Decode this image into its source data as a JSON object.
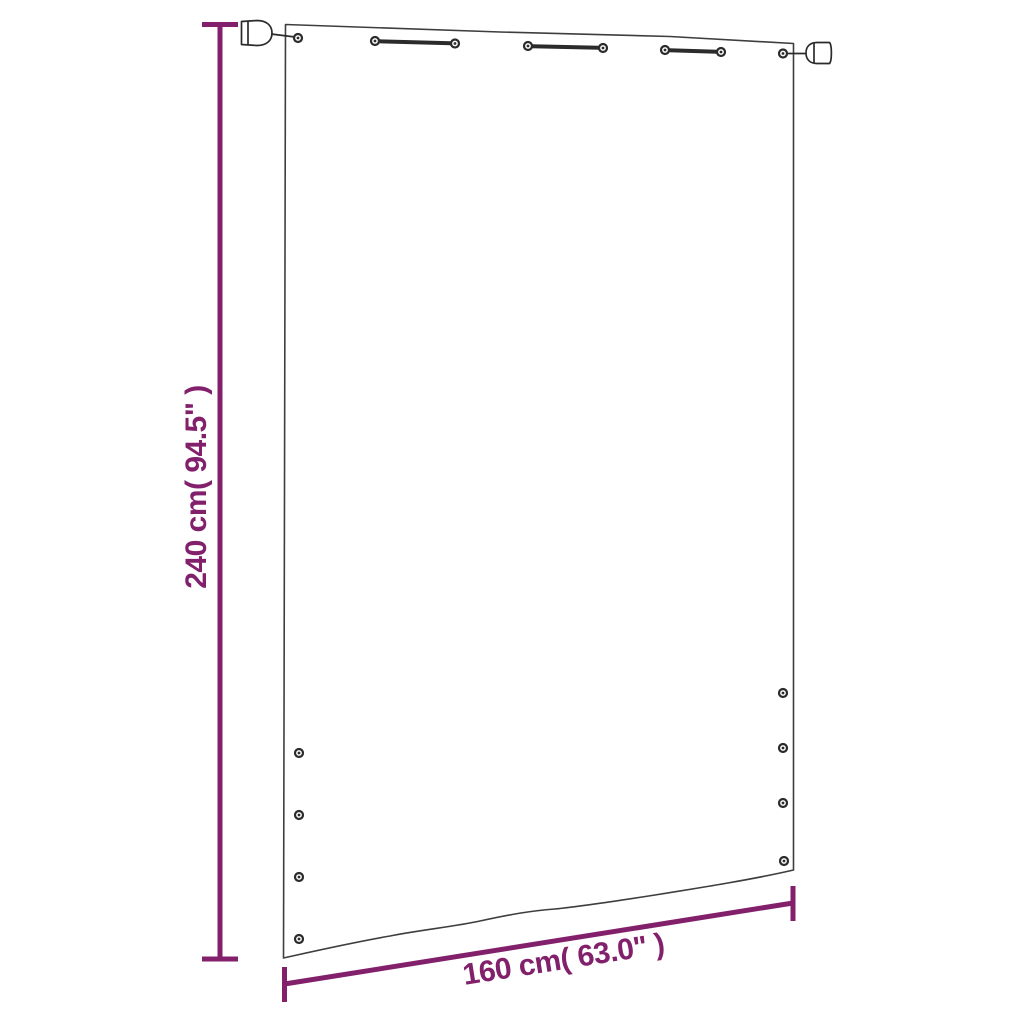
{
  "colors": {
    "dimension": "#82206C",
    "outline": "#3E3E3E",
    "hardware": "#2B2B2B",
    "background": "#FFFFFF"
  },
  "dimensions": {
    "height": {
      "label": "240 cm( 94.5\" )",
      "cm": 240,
      "inches": 94.5
    },
    "width": {
      "label": "160 cm( 63.0\" )",
      "cm": 160,
      "inches": 63.0
    }
  }
}
